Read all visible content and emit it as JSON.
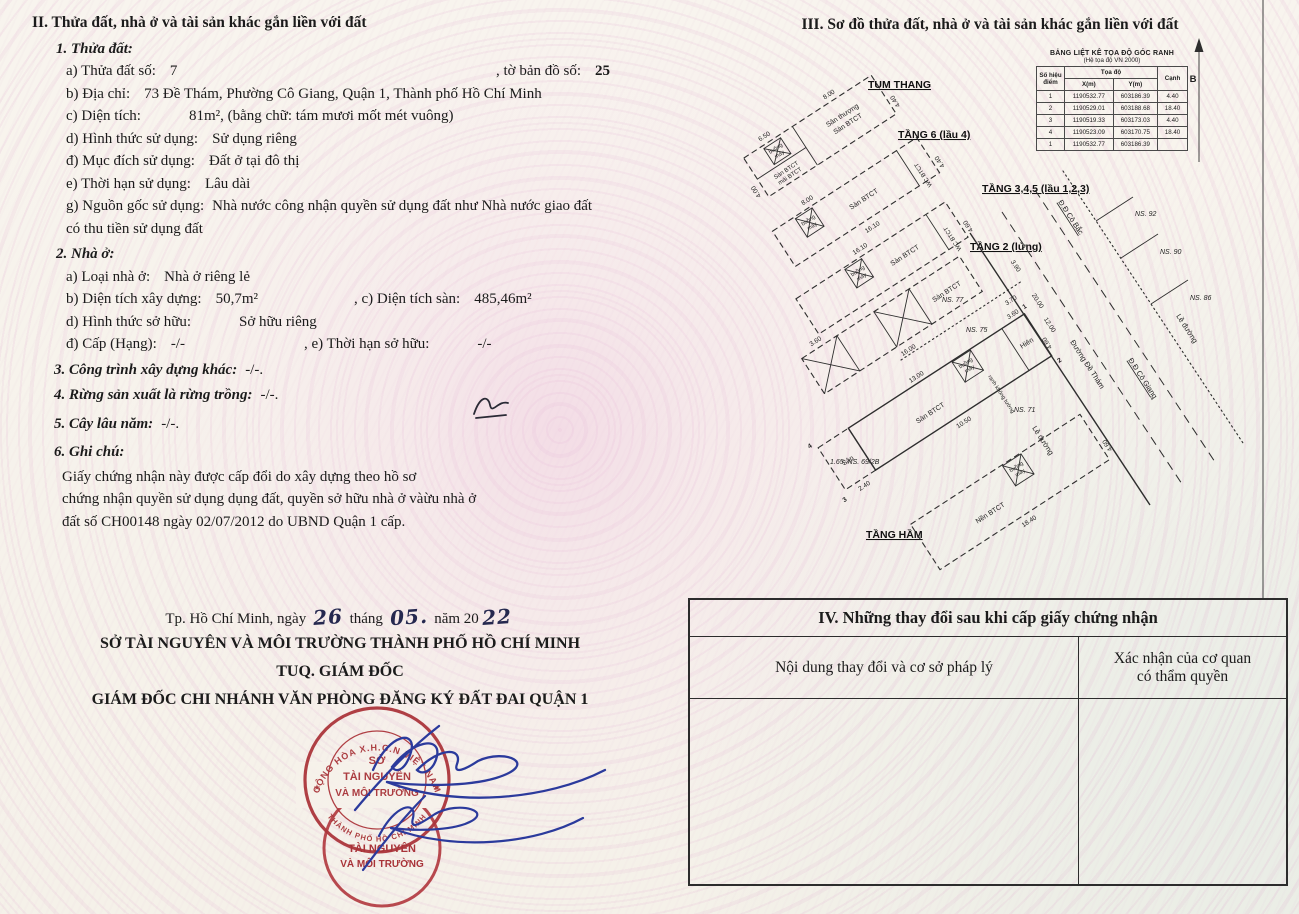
{
  "doc": {
    "s2": {
      "title": "II. Thửa đất, nhà ở và tài sản khác gắn liền với đất",
      "b1": {
        "h": "1. Thửa đất:",
        "a_l": "a) Thửa đất số:",
        "a_v": "7",
        "a_l2": ", tờ bản đồ số:",
        "a_v2": "25",
        "b_l": "b) Địa chỉ:",
        "b_v": "73 Đề Thám, Phường Cô Giang, Quận 1, Thành phố Hồ Chí Minh",
        "c_l": "c) Diện tích:",
        "c_v": "81m²",
        "c_s": ", (bằng chữ: tám mươi mốt mét vuông)",
        "d_l": "d) Hình thức sử dụng:",
        "d_v": "Sử dụng riêng",
        "dd_l": "đ) Mục đích sử dụng:",
        "dd_v": "Đất ở tại đô thị",
        "e_l": "e) Thời hạn sử dụng:",
        "e_v": "Lâu dài",
        "g_l": "g) Nguồn gốc sử dụng:",
        "g_v1": "Nhà nước công nhận quyền sử dụng đất như Nhà nước giao đất",
        "g_v2": "có thu tiền sử dụng đất"
      },
      "b2": {
        "h": "2. Nhà ở:",
        "a_l": "a) Loại nhà ở:",
        "a_v": "Nhà ở riêng lẻ",
        "b_l": "b) Diện tích xây dựng:",
        "b_v": "50,7m²",
        "c_l": ", c) Diện tích sàn:",
        "c_v": "485,46m²",
        "d_l": "d) Hình thức sở hữu:",
        "d_v": "Sở hữu riêng",
        "dd_l": "đ) Cấp (Hạng):",
        "dd_v": "-/-",
        "e_l": ", e) Thời hạn sở hữu:",
        "e_v": "-/-"
      },
      "b3_l": "3. Công trình xây dựng khác:",
      "b3_v": "-/-.",
      "b4_l": "4. Rừng sản xuất là rừng trồng:",
      "b4_v": "-/-.",
      "b5_l": "5. Cây lâu năm:",
      "b5_v": "-/-.",
      "b6_h": "6. Ghi chú:",
      "b6_1": "Giấy chứng nhận này được cấp đổi do xây dựng theo hồ sơ",
      "b6_2": "chứng nhận quyền sử dụng dụng đất, quyền sở hữu nhà ở vàừu nhà ở",
      "b6_3": "đất số CH00148 ngày 02/07/2012 do UBND Quận 1 cấp."
    },
    "sig": {
      "place": "Tp. Hồ Chí Minh, ngày",
      "day": "26",
      "thang": "tháng",
      "month": "05.",
      "nam": "năm 20",
      "year": "22",
      "org": "SỞ TÀI NGUYÊN VÀ MÔI TRƯỜNG THÀNH PHỐ HỒ CHÍ MINH",
      "tuq": "TUQ. GIÁM ĐỐC",
      "director": "GIÁM ĐỐC CHI NHÁNH VĂN PHÒNG ĐĂNG KÝ ĐẤT ĐAI QUẬN 1",
      "stamp_ring": "CỘNG HÒA X.H.C.N VIỆT NAM",
      "stamp_ring2": "THÀNH PHỐ HỒ CHÍ MINH",
      "star": "★",
      "stamp_l1": "SỞ",
      "stamp_l2": "TÀI NGUYÊN",
      "stamp_l3": "VÀ MÔI TRƯỜNG",
      "stamp2_l1": "TÀI NGUYÊN",
      "stamp2_l2": "VÀ MÔI TRƯỜNG"
    },
    "s3": {
      "title": "III. Sơ đồ thửa đất, nhà ở và tài sản khác gắn liền với đất",
      "table": {
        "title": "BẢNG LIỆT KÊ TỌA ĐỘ GÓC RANH",
        "subtitle": "(Hệ tọa độ VN 2000)",
        "h_point1": "Số hiệu",
        "h_point2": "điểm",
        "h_toado": "Tọa độ",
        "h_x": "X(m)",
        "h_y": "Y(m)",
        "h_canh": "Cạnh",
        "rows": [
          [
            "1",
            "1190532.77",
            "603186.39",
            "4.40"
          ],
          [
            "2",
            "1190529.01",
            "603188.68",
            "18.40"
          ],
          [
            "3",
            "1190519.33",
            "603173.03",
            "4.40"
          ],
          [
            "4",
            "1190523.09",
            "603170.75",
            "18.40"
          ],
          [
            "1",
            "1190532.77",
            "603186.39",
            ""
          ]
        ]
      },
      "north": "B",
      "floors": [
        "TUM THANG",
        "TẦNG 6 (lầu 4)",
        "TẦNG 3,4,5 (lầu 1,2,3)",
        "TẦNG 2 (lửng)",
        "TẦNG HẦM"
      ],
      "plan": {
        "san_thuong": "Sân thượng",
        "san_btct": "Sàn BTCT",
        "mai_btct": "mái BTCT",
        "buong": "buồng",
        "may": "máy",
        "wc": "WC BTCT",
        "hien": "Hiên",
        "san": "Sân",
        "nen": "Nền BTCT",
        "ranh": "ranh không tường"
      },
      "streets": {
        "de_tham": "Đường Đề Thám",
        "le_duong": "Lề đường",
        "co_bac": "Đ.Đ Cô Bắc",
        "co_giang": "Đ.Đ Cô Giang"
      },
      "ns": [
        "NS. 92",
        "NS. 90",
        "NS. 86",
        "NS. 77",
        "NS. 75",
        "NS. 71",
        "1.65; NS. 69/2B"
      ],
      "dims": [
        "8.00",
        "4.40",
        "4.00",
        "16.10",
        "16.00",
        "18.40",
        "13.00",
        "10.50",
        "2.40",
        "3.90",
        "20.00",
        "12.00",
        "3.70",
        "4.60",
        "3.60",
        "6.50"
      ],
      "pts": [
        "1",
        "2",
        "3",
        "4"
      ]
    },
    "s4": {
      "title": "IV. Những thay đổi sau khi cấp giấy chứng nhận",
      "col1": "Nội dung thay đổi và cơ sở pháp lý",
      "col2": "Xác nhận của cơ quan có thẩm quyền"
    }
  }
}
